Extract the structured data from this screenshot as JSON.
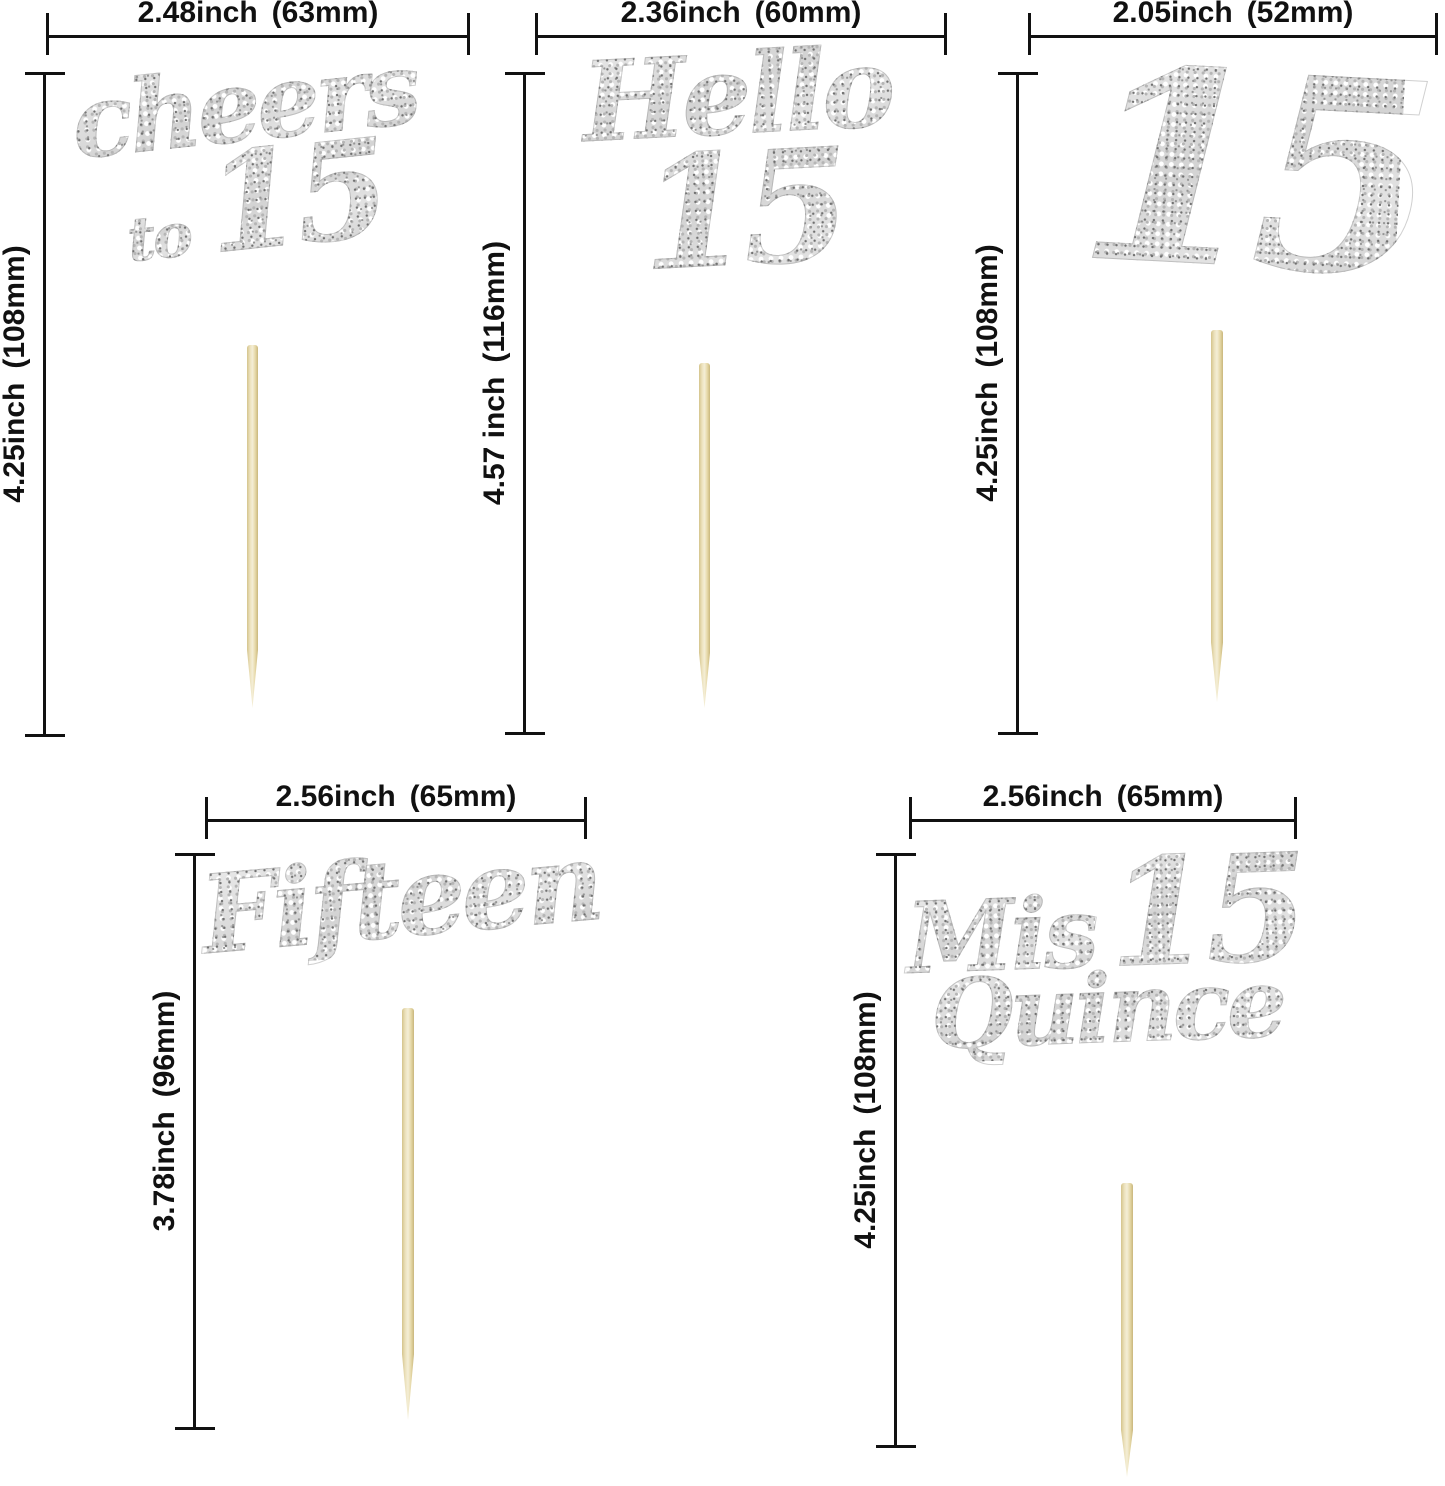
{
  "image_type": "product-dimension-diagram",
  "product": "Silver glitter 15th birthday / quinceanera cake toppers on wooden picks",
  "colors": {
    "background": "#ffffff",
    "dimension_lines": "#111111",
    "glitter_silver": "#d6d6d6",
    "wooden_stick": "#e9dcae"
  },
  "toppers": [
    {
      "name": "cheers-to-15",
      "art": {
        "word1": "cheers",
        "word2": "to",
        "num": "15"
      },
      "width": {
        "inch": "2.48inch",
        "mm": "(63mm)"
      },
      "height": {
        "inch": "4.25inch",
        "mm": "(108mm)"
      }
    },
    {
      "name": "hello-15",
      "art": {
        "word1": "Hello",
        "num": "15"
      },
      "width": {
        "inch": "2.36inch",
        "mm": "(60mm)"
      },
      "height": {
        "inch": "4.57 inch",
        "mm": "(116mm)"
      }
    },
    {
      "name": "15",
      "art": {
        "num": "15"
      },
      "width": {
        "inch": "2.05inch",
        "mm": "(52mm)"
      },
      "height": {
        "inch": "4.25inch",
        "mm": "(108mm)"
      }
    },
    {
      "name": "fifteen",
      "art": {
        "word1": "Fifteen"
      },
      "width": {
        "inch": "2.56inch",
        "mm": "(65mm)"
      },
      "height": {
        "inch": "3.78inch",
        "mm": "(96mm)"
      }
    },
    {
      "name": "mis-quince-15",
      "art": {
        "word1": "Mis",
        "num": "15",
        "word2": "Quince"
      },
      "width": {
        "inch": "2.56inch",
        "mm": "(65mm)"
      },
      "height": {
        "inch": "4.25inch",
        "mm": "(108mm)"
      }
    }
  ]
}
